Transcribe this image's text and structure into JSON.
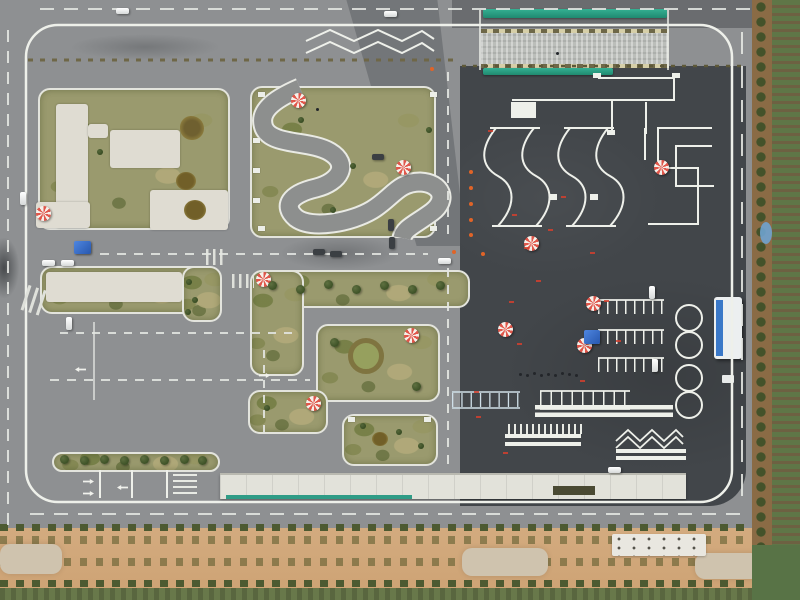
{
  "scene": {
    "description": "Aerial drone photograph of a driving-school practice and test course: left half is a simulated street grid with grass islands, crosswalks and parked cars; right half is a dark asphalt pad with painted white test figures (S-curves, right-angle turns, figure-eights, parking bays), a green-edged hill-start ramp at top, red/white instructor umbrellas, blue tents and cones; sandy planted strips border the bottom and right edges."
  },
  "palette": {
    "asphalt_light": "#8e9092",
    "asphalt_dark": "#42464a",
    "marking_white": "#eef0ea",
    "grass": "#9a9a6e",
    "concrete_pad": "#dfdcd2",
    "sand": "#d3ab7f",
    "dirt": "#8a6b45",
    "field_green": "#5f7647",
    "ramp_green": "#2aa58c",
    "umbrella_red": "#e0564a",
    "tent_blue": "#2f6fd6",
    "cone_orange": "#e06428",
    "canopy_white": "#e2e2da",
    "shelter_blue": "#3a78c8"
  },
  "objects": [
    {
      "kind": "umbrella",
      "x": 291,
      "y": 93
    },
    {
      "kind": "umbrella",
      "x": 396,
      "y": 160
    },
    {
      "kind": "umbrella",
      "x": 36,
      "y": 206
    },
    {
      "kind": "umbrella",
      "x": 256,
      "y": 272
    },
    {
      "kind": "umbrella",
      "x": 404,
      "y": 328
    },
    {
      "kind": "umbrella",
      "x": 306,
      "y": 396
    },
    {
      "kind": "umbrella",
      "x": 498,
      "y": 322
    },
    {
      "kind": "umbrella",
      "x": 586,
      "y": 296
    },
    {
      "kind": "umbrella",
      "x": 577,
      "y": 338
    },
    {
      "kind": "umbrella",
      "x": 654,
      "y": 160
    },
    {
      "kind": "umbrella",
      "x": 524,
      "y": 236
    },
    {
      "kind": "tent-blue",
      "x": 74,
      "y": 241,
      "w": 17,
      "h": 13
    },
    {
      "kind": "tent-blue",
      "x": 584,
      "y": 330,
      "w": 16,
      "h": 14
    },
    {
      "kind": "car-white",
      "x": 116,
      "y": 8
    },
    {
      "kind": "car-white",
      "x": 384,
      "y": 11
    },
    {
      "kind": "car-white",
      "x": 42,
      "y": 260
    },
    {
      "kind": "car-white",
      "x": 61,
      "y": 260
    },
    {
      "kind": "car-white",
      "x": 438,
      "y": 258
    },
    {
      "kind": "car-white",
      "x": 608,
      "y": 467
    },
    {
      "kind": "car-white",
      "x": 20,
      "y": 192,
      "o": "v"
    },
    {
      "kind": "car-white",
      "x": 66,
      "y": 317,
      "o": "v"
    },
    {
      "kind": "car-white",
      "x": 649,
      "y": 286,
      "o": "v"
    },
    {
      "kind": "car-white",
      "x": 652,
      "y": 359,
      "o": "v"
    },
    {
      "kind": "car-dark",
      "x": 313,
      "y": 249
    },
    {
      "kind": "car-dark",
      "x": 330,
      "y": 251
    },
    {
      "kind": "car-dark",
      "x": 372,
      "y": 154
    },
    {
      "kind": "car-dark",
      "x": 388,
      "y": 219,
      "o": "v"
    },
    {
      "kind": "car-dark",
      "x": 389,
      "y": 237,
      "o": "v"
    },
    {
      "kind": "cone",
      "x": 469,
      "y": 170
    },
    {
      "kind": "cone",
      "x": 469,
      "y": 186
    },
    {
      "kind": "cone",
      "x": 469,
      "y": 202
    },
    {
      "kind": "cone",
      "x": 469,
      "y": 218
    },
    {
      "kind": "cone",
      "x": 469,
      "y": 233
    },
    {
      "kind": "cone",
      "x": 452,
      "y": 250
    },
    {
      "kind": "cone",
      "x": 481,
      "y": 252
    },
    {
      "kind": "cone",
      "x": 430,
      "y": 67
    },
    {
      "kind": "red-mark",
      "x": 512,
      "y": 214
    },
    {
      "kind": "red-mark",
      "x": 524,
      "y": 247
    },
    {
      "kind": "red-mark",
      "x": 536,
      "y": 280
    },
    {
      "kind": "red-mark",
      "x": 509,
      "y": 301
    },
    {
      "kind": "red-mark",
      "x": 517,
      "y": 343
    },
    {
      "kind": "red-mark",
      "x": 548,
      "y": 229
    },
    {
      "kind": "red-mark",
      "x": 561,
      "y": 196
    },
    {
      "kind": "red-mark",
      "x": 474,
      "y": 391
    },
    {
      "kind": "red-mark",
      "x": 503,
      "y": 452
    },
    {
      "kind": "red-mark",
      "x": 476,
      "y": 416
    },
    {
      "kind": "red-mark",
      "x": 590,
      "y": 252
    },
    {
      "kind": "red-mark",
      "x": 604,
      "y": 300
    },
    {
      "kind": "red-mark",
      "x": 616,
      "y": 340
    },
    {
      "kind": "red-mark",
      "x": 580,
      "y": 380
    },
    {
      "kind": "red-mark",
      "x": 488,
      "y": 130
    },
    {
      "kind": "person",
      "x": 519,
      "y": 373
    },
    {
      "kind": "person",
      "x": 526,
      "y": 374
    },
    {
      "kind": "person",
      "x": 533,
      "y": 372
    },
    {
      "kind": "person",
      "x": 540,
      "y": 374
    },
    {
      "kind": "person",
      "x": 547,
      "y": 373
    },
    {
      "kind": "person",
      "x": 554,
      "y": 374
    },
    {
      "kind": "person",
      "x": 561,
      "y": 372
    },
    {
      "kind": "person",
      "x": 568,
      "y": 373
    },
    {
      "kind": "person",
      "x": 575,
      "y": 374
    },
    {
      "kind": "person",
      "x": 316,
      "y": 108
    },
    {
      "kind": "person",
      "x": 556,
      "y": 52
    },
    {
      "kind": "tree",
      "x": 60,
      "y": 455
    },
    {
      "kind": "tree",
      "x": 80,
      "y": 456
    },
    {
      "kind": "tree",
      "x": 100,
      "y": 455
    },
    {
      "kind": "tree",
      "x": 120,
      "y": 456
    },
    {
      "kind": "tree",
      "x": 140,
      "y": 455
    },
    {
      "kind": "tree",
      "x": 160,
      "y": 456
    },
    {
      "kind": "tree",
      "x": 180,
      "y": 455
    },
    {
      "kind": "tree",
      "x": 198,
      "y": 456
    },
    {
      "kind": "tree",
      "x": 268,
      "y": 281
    },
    {
      "kind": "tree",
      "x": 296,
      "y": 285
    },
    {
      "kind": "tree",
      "x": 324,
      "y": 280
    },
    {
      "kind": "tree",
      "x": 352,
      "y": 285
    },
    {
      "kind": "tree",
      "x": 380,
      "y": 281
    },
    {
      "kind": "tree",
      "x": 408,
      "y": 285
    },
    {
      "kind": "tree",
      "x": 436,
      "y": 281
    },
    {
      "kind": "tree",
      "x": 330,
      "y": 338
    },
    {
      "kind": "tree",
      "x": 412,
      "y": 382
    },
    {
      "kind": "bush",
      "x": 360,
      "y": 423
    },
    {
      "kind": "bush",
      "x": 396,
      "y": 429
    },
    {
      "kind": "bush",
      "x": 418,
      "y": 443
    },
    {
      "kind": "bush",
      "x": 264,
      "y": 405
    },
    {
      "kind": "bush",
      "x": 298,
      "y": 117
    },
    {
      "kind": "bush",
      "x": 330,
      "y": 207
    },
    {
      "kind": "bush",
      "x": 426,
      "y": 127
    },
    {
      "kind": "bush",
      "x": 350,
      "y": 163
    },
    {
      "kind": "bush",
      "x": 186,
      "y": 279
    },
    {
      "kind": "bush",
      "x": 192,
      "y": 297
    },
    {
      "kind": "bush",
      "x": 185,
      "y": 309
    },
    {
      "kind": "bush",
      "x": 97,
      "y": 149
    },
    {
      "kind": "curb-block",
      "x": 258,
      "y": 92
    },
    {
      "kind": "curb-block",
      "x": 430,
      "y": 92
    },
    {
      "kind": "curb-block",
      "x": 258,
      "y": 226
    },
    {
      "kind": "curb-block",
      "x": 430,
      "y": 226
    },
    {
      "kind": "curb-block",
      "x": 348,
      "y": 417
    },
    {
      "kind": "curb-block",
      "x": 424,
      "y": 417
    },
    {
      "kind": "curb-block",
      "x": 253,
      "y": 138
    },
    {
      "kind": "curb-block",
      "x": 253,
      "y": 168
    },
    {
      "kind": "curb-block",
      "x": 253,
      "y": 198
    },
    {
      "kind": "bed-star",
      "x": 180,
      "y": 116,
      "w": 24,
      "h": 24
    },
    {
      "kind": "bed-round",
      "x": 176,
      "y": 172,
      "w": 20,
      "h": 18
    },
    {
      "kind": "bed-round",
      "x": 184,
      "y": 200,
      "w": 22,
      "h": 20
    },
    {
      "kind": "bed-round",
      "x": 372,
      "y": 432,
      "w": 16,
      "h": 14
    },
    {
      "kind": "bed-ring",
      "x": 348,
      "y": 338,
      "w": 36,
      "h": 36
    },
    {
      "kind": "arrow",
      "x": 86,
      "y": 476,
      "o": "r90"
    },
    {
      "kind": "arrow",
      "x": 86,
      "y": 488,
      "o": "r90"
    },
    {
      "kind": "arrow",
      "x": 120,
      "y": 482,
      "o": "r270"
    },
    {
      "kind": "arrow",
      "x": 78,
      "y": 364,
      "o": "r270"
    },
    {
      "kind": "arrow",
      "x": 262,
      "y": 370,
      "o": "r90"
    }
  ]
}
